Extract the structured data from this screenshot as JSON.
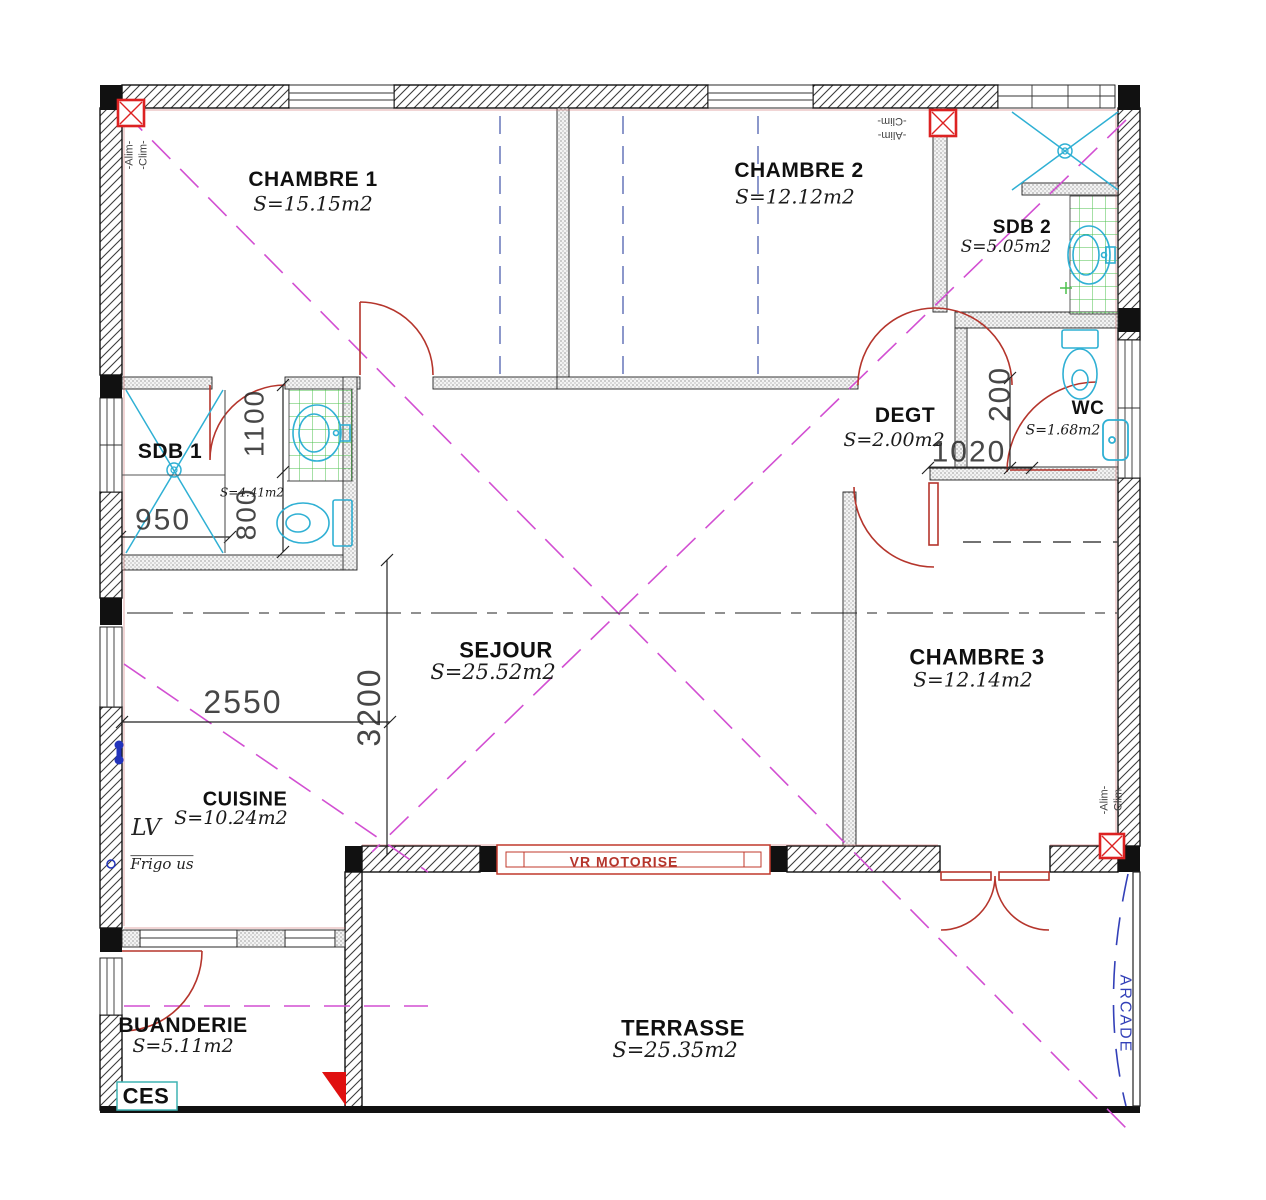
{
  "rooms": [
    {
      "name": "CHAMBRE 1",
      "area": "S=15.15m2"
    },
    {
      "name": "CHAMBRE 2",
      "area": "S=12.12m2"
    },
    {
      "name": "SDB 2",
      "area": "S=5.05m2"
    },
    {
      "name": "WC",
      "area": "S=1.68m2"
    },
    {
      "name": "DEGT",
      "area": "S=2.00m2"
    },
    {
      "name": "SDB 1",
      "area": "S=4.41m2"
    },
    {
      "name": "SEJOUR",
      "area": "S=25.52m2"
    },
    {
      "name": "CHAMBRE 3",
      "area": "S=12.14m2"
    },
    {
      "name": "CUISINE",
      "area": "S=10.24m2"
    },
    {
      "name": "BUANDERIE",
      "area": "S=5.11m2"
    },
    {
      "name": "TERRASSE",
      "area": "S=25.35m2"
    }
  ],
  "dimensions": {
    "cuisine_width": "2550",
    "sejour_depth": "3200",
    "sdb1_width": "950",
    "sdb1_len1": "1100",
    "sdb1_len2": "800",
    "degt_depth": "200",
    "degt_width": "1020"
  },
  "annotations": {
    "vr_motorise": "VR MOTORISE",
    "arcade": "ARCADE",
    "ces": "CES",
    "lave_vaisselle": "LV",
    "frigo": "Frigo  us",
    "alim": "-Alim-",
    "clim": "-Clim-"
  },
  "colors": {
    "wall": "#1a1a1a",
    "door": "#b5352c",
    "fixture": "#2fb0d4",
    "tile": "#4cc04c",
    "guide": "#d24fd2",
    "wardrobe": "#5b6bb5",
    "arcade": "#3340b8",
    "clim_box": "#dd2222",
    "dimension": "#333333"
  }
}
